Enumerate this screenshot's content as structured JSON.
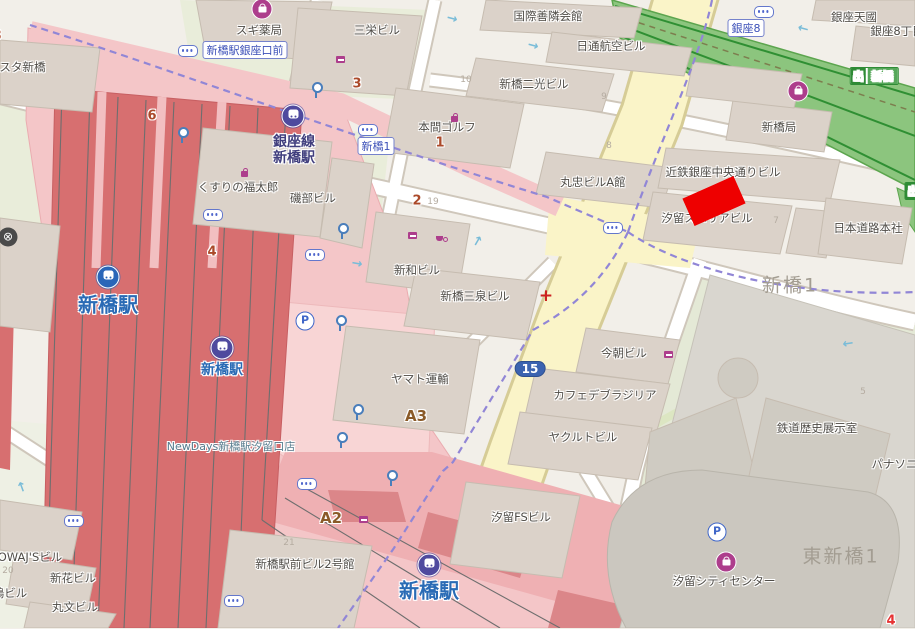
{
  "marker": {
    "color": "#ee0000"
  },
  "labels": [
    {
      "name": "poi-sugi-pharmacy",
      "text": "スギ薬局",
      "x": 259,
      "y": 30,
      "cls": "poi"
    },
    {
      "name": "poi-sanei-building",
      "text": "三栄ビル",
      "x": 377,
      "y": 30,
      "cls": "poi"
    },
    {
      "name": "poi-kokusai-zenrin-kaikan",
      "text": "国際善隣会館",
      "x": 548,
      "y": 16,
      "cls": "poi"
    },
    {
      "name": "poi-nittsu-air-building",
      "text": "日通航空ビル",
      "x": 611,
      "y": 46,
      "cls": "poi"
    },
    {
      "name": "poi-shimbashi-niko-building",
      "text": "新橋二光ビル",
      "x": 534,
      "y": 84,
      "cls": "poi"
    },
    {
      "name": "poi-homma-golf",
      "text": "本間ゴルフ",
      "x": 447,
      "y": 127,
      "cls": "poi"
    },
    {
      "name": "poi-ginza-tenkuni",
      "text": "銀座天國",
      "x": 854,
      "y": 17,
      "cls": "poi"
    },
    {
      "name": "poi-ginza-8chome",
      "text": "銀座8丁目",
      "x": 897,
      "y": 31,
      "cls": "poi"
    },
    {
      "name": "poi-shimbashi-post",
      "text": "新橋局",
      "x": 779,
      "y": 127,
      "cls": "poi"
    },
    {
      "name": "poi-maruchu-a",
      "text": "丸忠ビルA館",
      "x": 593,
      "y": 182,
      "cls": "poi"
    },
    {
      "name": "poi-kintetsu-ginza",
      "text": "近鉄銀座中央通りビル",
      "x": 723,
      "y": 172,
      "cls": "poi"
    },
    {
      "name": "poi-shiodome-superia",
      "text": "汐留スペリアビル",
      "x": 707,
      "y": 218,
      "cls": "poi"
    },
    {
      "name": "poi-nihon-doro",
      "text": "日本道路本社",
      "x": 868,
      "y": 228,
      "cls": "poi"
    },
    {
      "name": "poi-kusuri-fukutaro",
      "text": "くすりの福太郎",
      "x": 238,
      "y": 187,
      "cls": "poi"
    },
    {
      "name": "poi-isobe-building",
      "text": "磯部ビル",
      "x": 313,
      "y": 198,
      "cls": "poi"
    },
    {
      "name": "poi-shinwa-building",
      "text": "新和ビル",
      "x": 417,
      "y": 270,
      "cls": "poi"
    },
    {
      "name": "poi-sansen-building",
      "text": "新橋三泉ビル",
      "x": 475,
      "y": 296,
      "cls": "poi"
    },
    {
      "name": "poi-yamato-transport",
      "text": "ヤマト運輸",
      "x": 420,
      "y": 379,
      "cls": "poi"
    },
    {
      "name": "poi-kesa-building",
      "text": "今朝ビル",
      "x": 624,
      "y": 353,
      "cls": "poi"
    },
    {
      "name": "poi-cafe-brasilia",
      "text": "カフェデブラジリア",
      "x": 605,
      "y": 395,
      "cls": "poi"
    },
    {
      "name": "poi-yakult-building",
      "text": "ヤクルトビル",
      "x": 583,
      "y": 437,
      "cls": "poi"
    },
    {
      "name": "poi-shiodome-fs",
      "text": "汐留FSビル",
      "x": 521,
      "y": 517,
      "cls": "poi"
    },
    {
      "name": "poi-railway-history",
      "text": "鉄道歴史展示室",
      "x": 817,
      "y": 428,
      "cls": "poi"
    },
    {
      "name": "poi-panasonic",
      "text": "パナソニック",
      "x": 906,
      "y": 464,
      "cls": "poi"
    },
    {
      "name": "poi-shiodome-city-center",
      "text": "汐留シティセンター",
      "x": 724,
      "y": 581,
      "cls": "poi"
    },
    {
      "name": "poi-ekimae-bldg2",
      "text": "新橋駅前ビル2号館",
      "x": 305,
      "y": 564,
      "cls": "poi"
    },
    {
      "name": "poi-newdays",
      "text": "NewDays新橋駅汐留口店",
      "x": 231,
      "y": 446,
      "cls": "newdays"
    },
    {
      "name": "poi-owajs-building",
      "text": "OWAJ'Sビル",
      "x": 30,
      "y": 557,
      "cls": "poi"
    },
    {
      "name": "poi-shinka-building",
      "text": "新花ビル",
      "x": 73,
      "y": 578,
      "cls": "poi"
    },
    {
      "name": "poi-marubun-building",
      "text": "丸文ビル",
      "x": 75,
      "y": 607,
      "cls": "poi"
    },
    {
      "name": "poi-shima-building",
      "text": "嶋ビル",
      "x": 10,
      "y": 593,
      "cls": "poi"
    },
    {
      "name": "poi-palesta-shimbashi",
      "text": "パレスタ新橋",
      "x": 11,
      "y": 67,
      "cls": "poi"
    },
    {
      "name": "district-shimbashi-1",
      "text": "新橋1",
      "x": 790,
      "y": 284,
      "cls": "district"
    },
    {
      "name": "district-higashi-shimbashi-1",
      "text": "東新橋1",
      "x": 841,
      "y": 555,
      "cls": "district"
    },
    {
      "name": "station-jr-shimbashi",
      "text": "新橋駅",
      "x": 108,
      "y": 303,
      "cls": "st-big"
    },
    {
      "name": "station-metro-shimbashi",
      "text": "新橋駅",
      "x": 222,
      "y": 369,
      "cls": "st-mid"
    },
    {
      "name": "station-shimbashi-south",
      "text": "新橋駅",
      "x": 429,
      "y": 589,
      "cls": "st-big"
    },
    {
      "name": "station-ginza-line-1",
      "text": "銀座線",
      "x": 294,
      "y": 141,
      "cls": "st-ginza"
    },
    {
      "name": "station-ginza-line-2",
      "text": "新橋駅",
      "x": 294,
      "y": 157,
      "cls": "st-ginza"
    },
    {
      "name": "block-number-6",
      "text": "6",
      "x": 152,
      "y": 116,
      "cls": "num-red"
    },
    {
      "name": "block-number-3",
      "text": "3",
      "x": 357,
      "y": 84,
      "cls": "num-red"
    },
    {
      "name": "block-number-1",
      "text": "1",
      "x": 440,
      "y": 143,
      "cls": "num-red"
    },
    {
      "name": "block-number-2",
      "text": "2",
      "x": 417,
      "y": 201,
      "cls": "num-red"
    },
    {
      "name": "block-number-4",
      "text": "4",
      "x": 212,
      "y": 252,
      "cls": "num-red"
    },
    {
      "name": "block-number-8-edge",
      "text": "8",
      "x": -3,
      "y": 36,
      "cls": "num-red"
    },
    {
      "name": "block-number-4-southeast",
      "text": "4",
      "x": 891,
      "y": 621,
      "cls": "num-bright"
    },
    {
      "name": "exit-a2",
      "text": "A2",
      "x": 331,
      "y": 518,
      "cls": "exit-label"
    },
    {
      "name": "exit-a3",
      "text": "A3",
      "x": 416,
      "y": 416,
      "cls": "exit-label"
    },
    {
      "name": "lot-number-19",
      "text": "19",
      "x": 433,
      "y": 202,
      "cls": "faint"
    },
    {
      "name": "lot-number-10",
      "text": "10",
      "x": 466,
      "y": 80,
      "cls": "faint"
    },
    {
      "name": "lot-number-9",
      "text": "9",
      "x": 604,
      "y": 97,
      "cls": "faint"
    },
    {
      "name": "lot-number-8",
      "text": "8",
      "x": 609,
      "y": 146,
      "cls": "faint"
    },
    {
      "name": "lot-number-7",
      "text": "7",
      "x": 776,
      "y": 221,
      "cls": "faint"
    },
    {
      "name": "lot-number-5",
      "text": "5",
      "x": 863,
      "y": 392,
      "cls": "faint"
    },
    {
      "name": "lot-number-20",
      "text": "20",
      "x": 8,
      "y": 571,
      "cls": "faint"
    },
    {
      "name": "lot-number-21",
      "text": "21",
      "x": 289,
      "y": 543,
      "cls": "faint"
    },
    {
      "name": "bus-stop-ginzaguchi",
      "text": "新橋駅銀座口前",
      "x": 245,
      "y": 50,
      "cls": "bus"
    },
    {
      "name": "bus-stop-shimbashi-1",
      "text": "新橋1",
      "x": 376,
      "y": 146,
      "cls": "bus"
    },
    {
      "name": "bus-stop-ginza-8",
      "text": "銀座8",
      "x": 746,
      "y": 28,
      "cls": "bus"
    },
    {
      "name": "route-shield-15",
      "text": "15",
      "x": 530,
      "y": 369,
      "cls": "shield"
    }
  ],
  "icons": [
    {
      "name": "subway-station-icon",
      "type": "metro",
      "x": 293,
      "y": 116
    },
    {
      "name": "subway-station-icon",
      "type": "metro",
      "x": 222,
      "y": 348
    },
    {
      "name": "subway-station-icon",
      "type": "metro",
      "x": 429,
      "y": 565
    },
    {
      "name": "rail-station-icon",
      "type": "jr",
      "x": 108,
      "y": 277
    },
    {
      "name": "shop-bag-icon",
      "type": "bag-solid",
      "x": 262,
      "y": 9
    },
    {
      "name": "shop-bag-icon",
      "type": "bag-solid",
      "x": 798,
      "y": 91
    },
    {
      "name": "shop-bag-icon",
      "type": "bag-solid",
      "x": 726,
      "y": 562
    },
    {
      "name": "shop-bag-icon",
      "type": "bag-ring",
      "x": 446,
      "y": 109
    },
    {
      "name": "shop-bag-icon",
      "type": "bag-ring",
      "x": 236,
      "y": 164
    },
    {
      "name": "convenience-store-icon",
      "type": "conv-ring",
      "x": 332,
      "y": 51
    },
    {
      "name": "convenience-store-icon",
      "type": "conv-ring",
      "x": 404,
      "y": 227
    },
    {
      "name": "convenience-store-icon",
      "type": "conv-ring",
      "x": 660,
      "y": 346
    },
    {
      "name": "convenience-store-icon",
      "type": "conv-ring",
      "x": 355,
      "y": 511
    },
    {
      "name": "cafe-icon",
      "type": "cafe-ring",
      "x": 432,
      "y": 230
    },
    {
      "name": "parking-icon",
      "type": "parking",
      "x": 305,
      "y": 321,
      "glyph": "P"
    },
    {
      "name": "parking-icon",
      "type": "parking",
      "x": 717,
      "y": 532,
      "glyph": "P"
    },
    {
      "name": "bus-stop-icon",
      "type": "pill",
      "x": 188,
      "y": 51
    },
    {
      "name": "bus-stop-icon",
      "type": "pill",
      "x": 368,
      "y": 130
    },
    {
      "name": "bus-stop-icon",
      "type": "pill",
      "x": 213,
      "y": 215
    },
    {
      "name": "bus-stop-icon",
      "type": "pill",
      "x": 315,
      "y": 255
    },
    {
      "name": "bus-stop-icon",
      "type": "pill",
      "x": 613,
      "y": 228
    },
    {
      "name": "bus-stop-icon",
      "type": "pill",
      "x": 764,
      "y": 12
    },
    {
      "name": "bus-stop-icon",
      "type": "pill",
      "x": 307,
      "y": 484
    },
    {
      "name": "bus-stop-icon",
      "type": "pill",
      "x": 234,
      "y": 601
    },
    {
      "name": "bus-stop-icon",
      "type": "pill",
      "x": 74,
      "y": 521
    },
    {
      "name": "station-entrance-icon",
      "type": "entrance",
      "x": 182,
      "y": 135
    },
    {
      "name": "station-entrance-icon",
      "type": "entrance",
      "x": 316,
      "y": 90
    },
    {
      "name": "station-entrance-icon",
      "type": "entrance",
      "x": 342,
      "y": 231
    },
    {
      "name": "station-entrance-icon",
      "type": "entrance",
      "x": 340,
      "y": 323
    },
    {
      "name": "station-entrance-icon",
      "type": "entrance",
      "x": 357,
      "y": 412
    },
    {
      "name": "station-entrance-icon",
      "type": "entrance",
      "x": 341,
      "y": 440
    },
    {
      "name": "station-entrance-icon",
      "type": "entrance",
      "x": 391,
      "y": 478
    },
    {
      "name": "clinic-cross-icon",
      "type": "cross",
      "x": 546,
      "y": 296,
      "glyph": "+"
    },
    {
      "name": "amenity-icon",
      "type": "amenity",
      "x": 8,
      "y": 237,
      "glyph": "⊗"
    },
    {
      "name": "oneway-arrow-icon",
      "type": "arrow",
      "x": 452,
      "y": 19,
      "glyph": "→",
      "rot": 15
    },
    {
      "name": "oneway-arrow-icon",
      "type": "arrow",
      "x": 533,
      "y": 46,
      "glyph": "→",
      "rot": 15
    },
    {
      "name": "oneway-arrow-icon",
      "type": "arrow",
      "x": 803,
      "y": 29,
      "glyph": "←",
      "rot": 15
    },
    {
      "name": "oneway-arrow-icon",
      "type": "arrow",
      "x": 848,
      "y": 344,
      "glyph": "←",
      "rot": -8
    },
    {
      "name": "oneway-arrow-icon",
      "type": "arrow",
      "x": 22,
      "y": 488,
      "glyph": "↑",
      "rot": -20
    },
    {
      "name": "oneway-arrow-icon",
      "type": "arrow",
      "x": 357,
      "y": 264,
      "glyph": "→",
      "rot": 10
    },
    {
      "name": "oneway-arrow-icon",
      "type": "arrow",
      "x": 477,
      "y": 242,
      "glyph": "↑",
      "rot": 30
    }
  ],
  "exit_signs": [
    {
      "name": "exit-sign-shimbashi",
      "x": 874,
      "y": 76,
      "out": "出",
      "label": "新橋"
    },
    {
      "name": "exit-sign-edge",
      "x": 913,
      "y": 191,
      "out": "出",
      "label": ""
    }
  ]
}
